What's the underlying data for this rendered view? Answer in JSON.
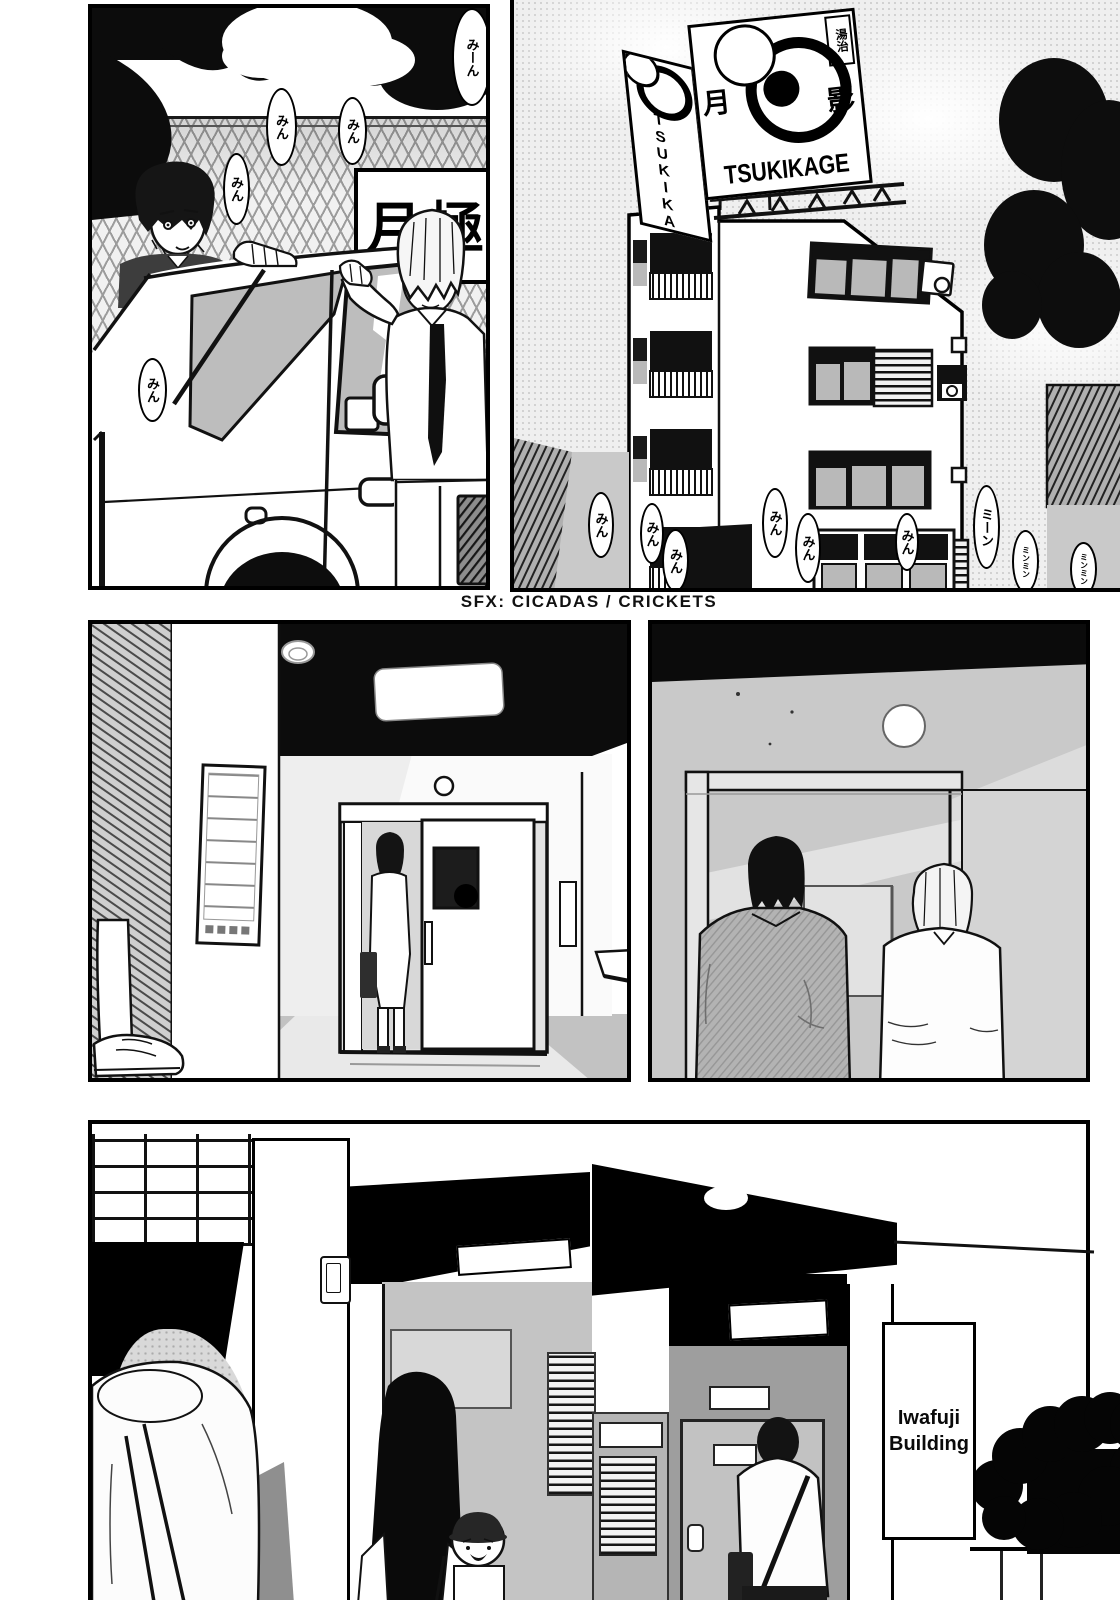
{
  "caption": {
    "sfx_label": "SFX: CICADAS / CRICKETS"
  },
  "signs": {
    "tsukikage": {
      "kanji_left": "月",
      "kanji_right": "影",
      "romaji": "TSUKIKAGE",
      "corner_label": "湯治",
      "side_romaji": "TSUKIKAGE"
    },
    "monthly_parking": "月極",
    "iwafuji": {
      "line1": "Iwafuji",
      "line2": "Building"
    }
  },
  "sfx_bubbles": {
    "p1": [
      "みーん",
      "みん",
      "みん",
      "みん",
      "みん"
    ],
    "p2": [
      "みん",
      "みん",
      "みん",
      "みん",
      "みん",
      "みん",
      "ミーン",
      "ミンミン",
      "ミンミン"
    ]
  },
  "colors": {
    "ink": "#000000",
    "paper": "#ffffff",
    "tone_gray": "#c9c9c9",
    "glass_gray": "#bdbdbd"
  }
}
